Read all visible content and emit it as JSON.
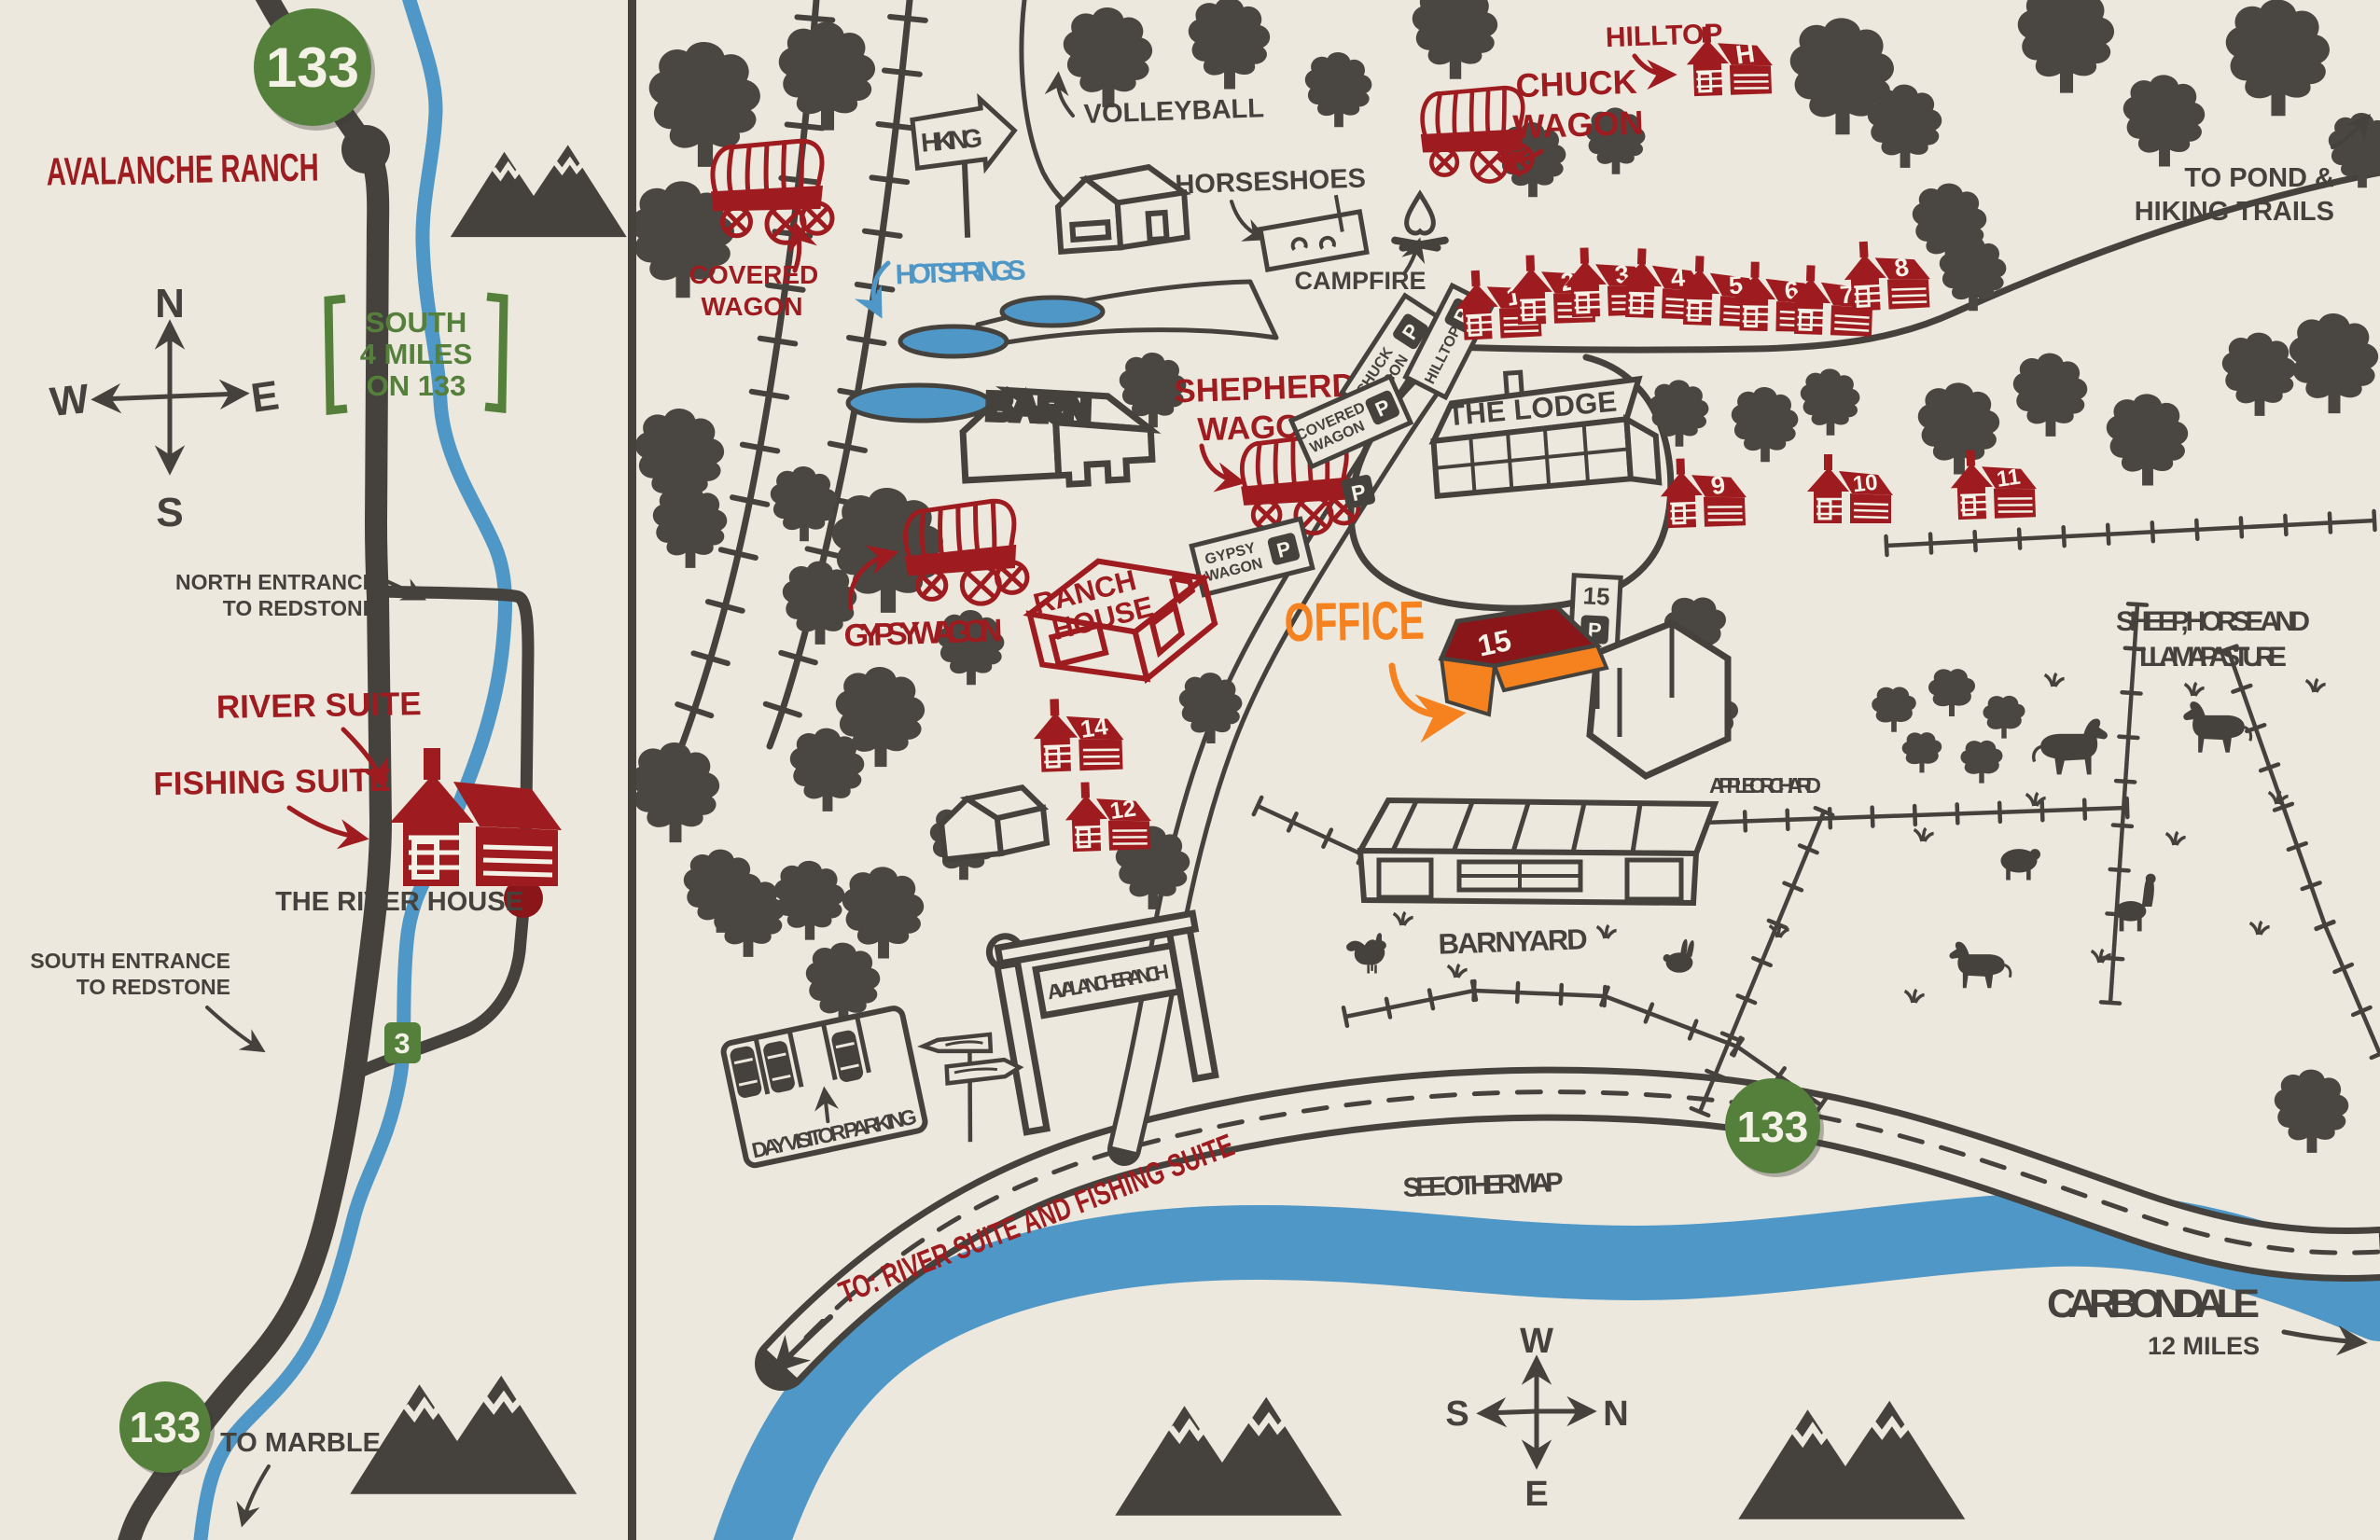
{
  "colors": {
    "background": "#ECE8DD",
    "ink": "#45423D",
    "tree": "#4A4641",
    "red": "#9E1C20",
    "dark_red_roof": "#8A161A",
    "orange": "#F5821F",
    "green": "#55803C",
    "blue": "#4E97C6",
    "cream": "#F4F1E6"
  },
  "left": {
    "badge_top": "133",
    "title": "AVALANCHE RANCH",
    "compass": {
      "n": "N",
      "e": "E",
      "s": "S",
      "w": "W"
    },
    "note": {
      "l1": "SOUTH",
      "l2": "4 MILES",
      "l3": "ON 133"
    },
    "north_entrance": {
      "l1": "NORTH ENTRANCE",
      "l2": "TO REDSTONE"
    },
    "river_suite": "RIVER SUITE",
    "fishing_suite": "FISHING SUITE",
    "river_house": "THE RIVER HOUSE",
    "south_entrance": {
      "l1": "SOUTH ENTRANCE",
      "l2": "TO REDSTONE"
    },
    "route_badge": "3",
    "badge_bottom": "133",
    "to_marble": "TO MARBLE"
  },
  "right": {
    "hiking_sign": "HIKING",
    "volleyball": "VOLLEYBALL",
    "horseshoes": "HORSESHOES",
    "campfire": "CAMPFIRE",
    "chuck_wagon": {
      "l1": "CHUCK",
      "l2": "WAGON"
    },
    "hilltop": "HILLTOP",
    "hilltop_initial": "H",
    "covered_wagon": {
      "l1": "COVERED",
      "l2": "WAGON"
    },
    "hot_springs": "HOT SPRINGS",
    "barn": "BARN",
    "shepherd_wagon": {
      "l1": "SHEPHERD",
      "l2": "WAGON"
    },
    "lodge": "THE LODGE",
    "gypsy_wagon": "GYPSY WAGON",
    "ranch_house": {
      "l1": "RANCH",
      "l2": "HOUSE"
    },
    "office": "OFFICE",
    "office_unit": "15",
    "to_pond": {
      "l1": "TO POND &",
      "l2": "HIKING TRAILS"
    },
    "cabin_row": [
      "1",
      "2",
      "3",
      "4",
      "5",
      "6",
      "7",
      "8"
    ],
    "cabin_row2": [
      "9",
      "10",
      "11"
    ],
    "cabin_14": "14",
    "cabin_12": "12",
    "parking": {
      "p": "P",
      "chuck": {
        "l1": "CHUCK",
        "l2": "WAGON"
      },
      "hilltop": "HILLTOP",
      "covered": {
        "l1": "COVERED",
        "l2": "WAGON"
      },
      "gypsy": {
        "l1": "GYPSY",
        "l2": "WAGON"
      },
      "unit15": "15"
    },
    "pasture": {
      "l1": "SHEEP, HORSE AND",
      "l2": "LLAMA PASTURE"
    },
    "apple_orchard": "APPLE ORCHARD",
    "barnyard": "BARNYARD",
    "day_parking": "DAY VISITOR PARKING",
    "gate_sign": "AVALANCHE RANCH",
    "to_suites": "TO: RIVER SUITE AND FISHING SUITE",
    "see_other_map": "SEE OTHER MAP",
    "badge_hwy": "133",
    "carbondale": "CARBONDALE",
    "carbondale_sub": "12 MILES",
    "compass": {
      "n": "N",
      "e": "E",
      "s": "S",
      "w": "W"
    }
  }
}
